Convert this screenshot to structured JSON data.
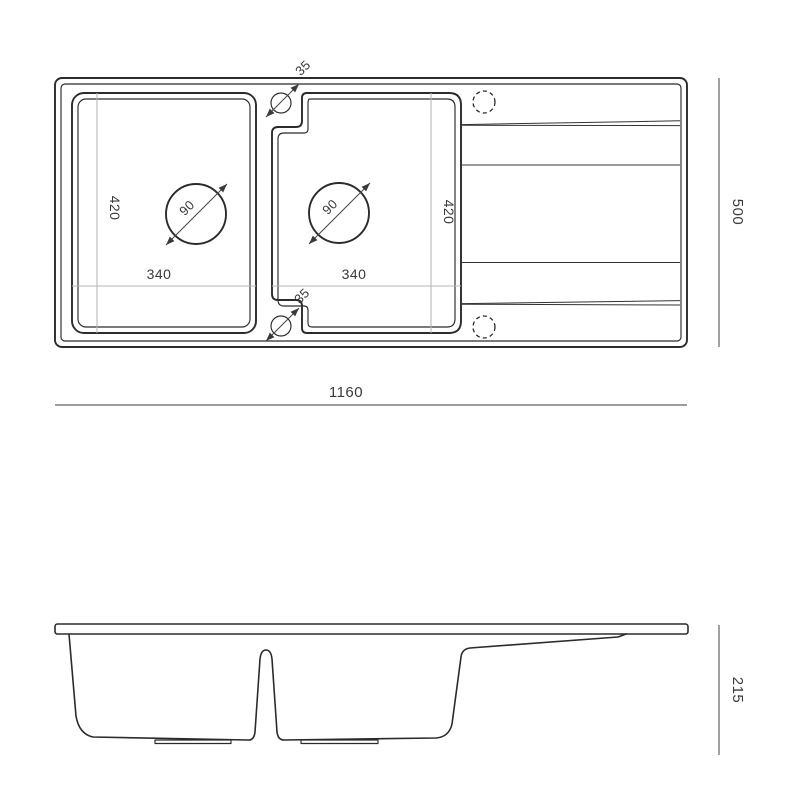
{
  "drawing_type": "kitchen-sink-technical-drawing",
  "colors": {
    "background": "#ffffff",
    "outline": "#2b2b2b",
    "dimension_line": "#9c9c9c",
    "bowl_dimension_line": "#b8b8b8",
    "text": "#3a3a3a"
  },
  "top_view": {
    "overall": {
      "width_label": "1160",
      "depth_label": "500"
    },
    "left_bowl": {
      "width_label": "340",
      "depth_label": "420",
      "drain_diameter_label": "90"
    },
    "right_bowl": {
      "width_label": "340",
      "depth_label": "420",
      "drain_diameter_label": "90"
    },
    "tap_holes": {
      "top_label": "35",
      "bottom_label": "35"
    }
  },
  "side_view": {
    "overall": {
      "height_label": "215"
    }
  }
}
